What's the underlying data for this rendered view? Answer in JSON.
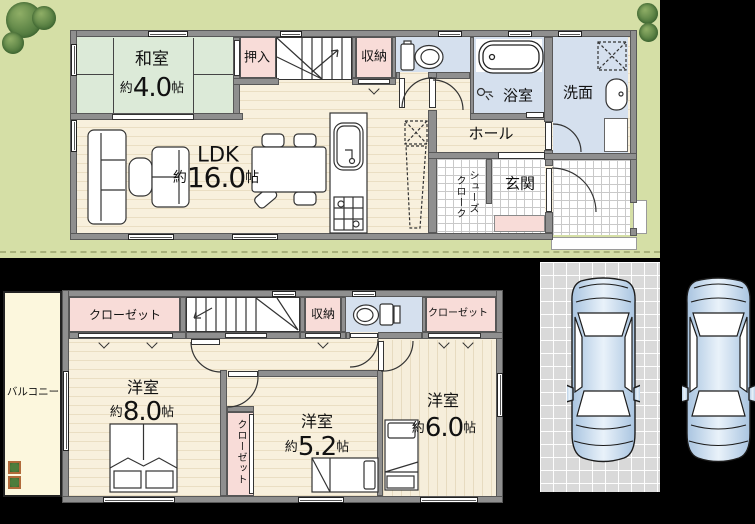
{
  "floor1": {
    "washitsu": {
      "label": "和室",
      "approx": "約",
      "num": "4.0",
      "unit": "帖"
    },
    "oshiire": {
      "label": "押入"
    },
    "storage": {
      "label": "収納"
    },
    "ldk": {
      "label": "LDK",
      "approx": "約",
      "num": "16.0",
      "unit": "帖"
    },
    "bath": {
      "label": "浴室"
    },
    "washroom": {
      "label": "洗面"
    },
    "hall": {
      "label": "ホール"
    },
    "shoes_cloak": {
      "col_right": "シューズ",
      "col_left": "クローク"
    },
    "genkan": {
      "label": "玄関"
    }
  },
  "floor2": {
    "closet_a": {
      "label": "クローゼット"
    },
    "storage": {
      "label": "収納"
    },
    "closet_b": {
      "label": "クローゼット"
    },
    "room_8": {
      "label": "洋室",
      "approx": "約",
      "num": "8.0",
      "unit": "帖"
    },
    "room_52": {
      "label": "洋室",
      "approx": "約",
      "num": "5.2",
      "unit": "帖"
    },
    "room_6": {
      "label": "洋室",
      "approx": "約",
      "num": "6.0",
      "unit": "帖"
    },
    "closet_c": {
      "label": "クローゼット"
    },
    "balcony": {
      "label": "バルコニー"
    }
  },
  "colors": {
    "lawn": "#d5dfa6",
    "wood": "#f8f0dd",
    "tatami": "#dcead8",
    "closet_pink": "#f8dcd8",
    "wet_blue": "#d5e0ee",
    "wall_gray": "#8f8f8f",
    "balcony_cream": "#fcf7dd",
    "parking_gray": "#d9d9d9",
    "car_blue": "#c7daed"
  }
}
